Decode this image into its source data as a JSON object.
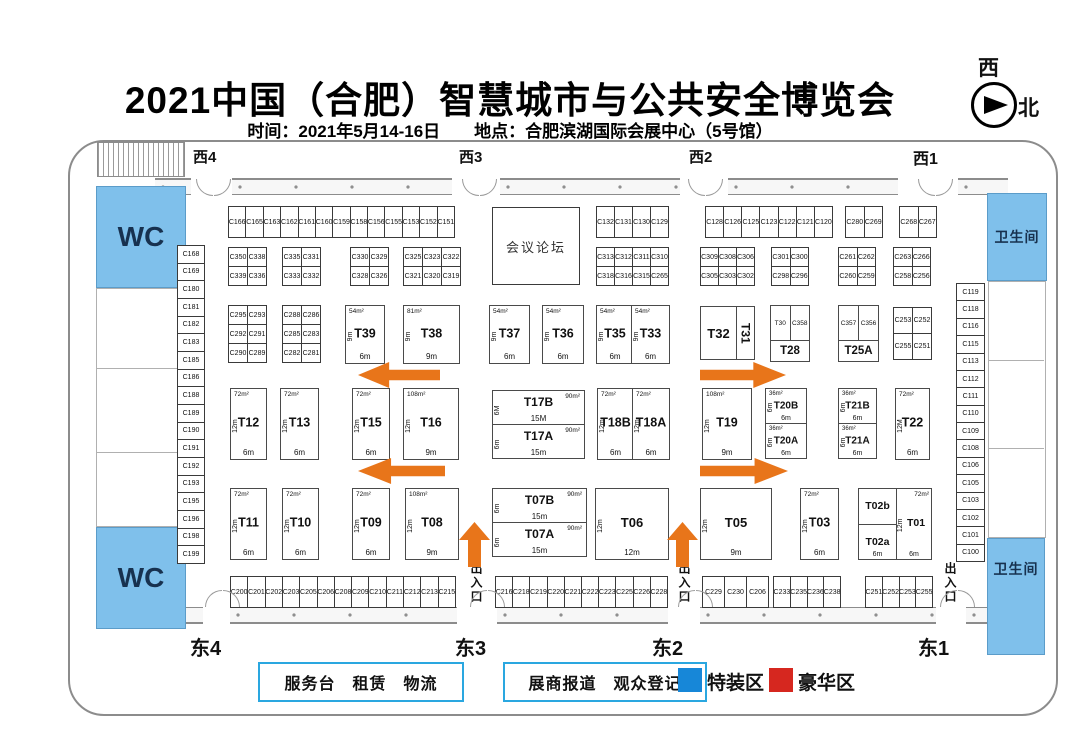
{
  "header": {
    "title": "2021中国（合肥）智慧城市与公共安全博览会",
    "subtitle": "时间：2021年5月14-16日　　地点：合肥滨湖国际会展中心（5号馆）",
    "compass_west": "西",
    "compass_north": "北"
  },
  "gates": {
    "west": [
      "西4",
      "西3",
      "西2",
      "西1"
    ],
    "east": [
      "东4",
      "东3",
      "东2",
      "东1"
    ],
    "entrance": "出入口"
  },
  "areas": {
    "wc": "WC",
    "restroom": "卫生间",
    "forum": "会议论坛"
  },
  "legend": {
    "service_box": "服务台　租赁　物流",
    "registration_box": "展商报道　观众登记",
    "special": "特装区",
    "deluxe": "豪华区"
  },
  "colors": {
    "arrow": "#e8751a",
    "facility_fill": "#7fc0eb",
    "legend_special": "#1787d8",
    "legend_deluxe": "#d6271f"
  },
  "cells": {
    "top_left": [
      "C166",
      "C165",
      "C163",
      "C162",
      "C161",
      "C160",
      "C159",
      "C158",
      "C156",
      "C155",
      "C153",
      "C152",
      "C151"
    ],
    "tr_a": [
      "C132",
      "C131",
      "C130",
      "C129"
    ],
    "tr_b": [
      "C128",
      "C126",
      "C125",
      "C123",
      "C122",
      "C121",
      "C120"
    ],
    "tr_c": [
      "C280",
      "C269"
    ],
    "tr_d": [
      "C268",
      "C267"
    ],
    "blk_c350": [
      "C350",
      "C338",
      "C339",
      "C336"
    ],
    "blk_c335": [
      "C335",
      "C331",
      "C333",
      "C332"
    ],
    "blk_c330": [
      "C330",
      "C329",
      "C328",
      "C326"
    ],
    "blk_c325": [
      "C325",
      "C323",
      "C322",
      "C321",
      "C320",
      "C319"
    ],
    "blk_c313": [
      "C313",
      "C312",
      "C311",
      "C310",
      "C318",
      "C316",
      "C315",
      "C265"
    ],
    "blk_c309": [
      "C309",
      "C308",
      "C306",
      "C305",
      "C303",
      "C302"
    ],
    "blk_c301": [
      "C301",
      "C300",
      "C298",
      "C296"
    ],
    "blk_c261": [
      "C261",
      "C262",
      "C260",
      "C259"
    ],
    "blk_c263": [
      "C263",
      "C266",
      "C258",
      "C256"
    ],
    "blk_c295": [
      "C295",
      "C293",
      "C292",
      "C291",
      "C290",
      "C289"
    ],
    "blk_c288": [
      "C288",
      "C286",
      "C285",
      "C283",
      "C282",
      "C281"
    ],
    "blk_c253": [
      "C253",
      "C252",
      "C255",
      "C251"
    ],
    "left_col": [
      "C168",
      "C169",
      "C180",
      "C181",
      "C182",
      "C183",
      "C185",
      "C186",
      "C188",
      "C189",
      "C190",
      "C191",
      "C192",
      "C193",
      "C195",
      "C196",
      "C198",
      "C199"
    ],
    "right_col": [
      "C119",
      "C118",
      "C116",
      "C115",
      "C113",
      "C112",
      "C111",
      "C110",
      "C109",
      "C108",
      "C106",
      "C105",
      "C103",
      "C102",
      "C101",
      "C100"
    ],
    "bottom_1": [
      "C200",
      "C201",
      "C202",
      "C203",
      "C205",
      "C206",
      "C208",
      "C209",
      "C210",
      "C211",
      "C212",
      "C213",
      "C215"
    ],
    "bottom_2": [
      "C216",
      "C218",
      "C219",
      "C220",
      "C221",
      "C222",
      "C223",
      "C225",
      "C226",
      "C228"
    ],
    "bottom_3": [
      "C229",
      "C230",
      "C206"
    ],
    "bottom_4": [
      "C233",
      "C235",
      "C236",
      "C238"
    ],
    "bottom_5": [
      "C251",
      "C252",
      "C253",
      "C255"
    ]
  },
  "t_booths": {
    "T39": {
      "id": "T39",
      "area": "54m²",
      "side": "9m",
      "front": "6m"
    },
    "T38": {
      "id": "T38",
      "area": "81m²",
      "side": "9m",
      "front": "9m"
    },
    "T37": {
      "id": "T37",
      "area": "54m²",
      "side": "9m",
      "front": "6m"
    },
    "T36": {
      "id": "T36",
      "area": "54m²",
      "side": "9m",
      "front": "6m"
    },
    "T35": {
      "id": "T35",
      "area": "54m²",
      "side": "9m",
      "front": "6m"
    },
    "T33": {
      "id": "T33",
      "area": "54m²",
      "side": "9m",
      "front": "6m"
    },
    "T12": {
      "id": "T12",
      "area": "72m²",
      "side": "12m",
      "front": "6m"
    },
    "T13": {
      "id": "T13",
      "area": "72m²",
      "side": "12m",
      "front": "6m"
    },
    "T15": {
      "id": "T15",
      "area": "72m²",
      "side": "12m",
      "front": "6m"
    },
    "T16": {
      "id": "T16",
      "area": "108m²",
      "side": "12m",
      "front": "9m"
    },
    "T17B": {
      "id": "T17B",
      "area": "90m²",
      "side": "6M",
      "front": "15M"
    },
    "T17A": {
      "id": "T17A",
      "area": "90m²",
      "side": "6m",
      "front": "15m"
    },
    "T18B": {
      "id": "T18B",
      "area": "72m²",
      "side": "12m",
      "front": "6m"
    },
    "T18A": {
      "id": "T18A",
      "area": "72m²",
      "side": "12m",
      "front": "6m"
    },
    "T19": {
      "id": "T19",
      "area": "108m²",
      "side": "12m",
      "front": "9m"
    },
    "T20B": {
      "id": "T20B",
      "area": "36m²",
      "side": "6m",
      "front": "6m"
    },
    "T20A": {
      "id": "T20A",
      "area": "36m²",
      "side": "6m",
      "front": "6m"
    },
    "T21B": {
      "id": "T21B",
      "area": "36m²",
      "side": "6m",
      "front": "6m"
    },
    "T21A": {
      "id": "T21A",
      "area": "36m²",
      "side": "6m",
      "front": "6m"
    },
    "T22": {
      "id": "T22",
      "area": "72m²",
      "side": "12M",
      "front": "6m"
    },
    "T11": {
      "id": "T11",
      "area": "72m²",
      "side": "12m",
      "front": "6m"
    },
    "T10": {
      "id": "T10",
      "area": "72m²",
      "side": "12m",
      "front": "6m"
    },
    "T09": {
      "id": "T09",
      "area": "72m²",
      "side": "12m",
      "front": "6m"
    },
    "T08": {
      "id": "T08",
      "area": "108m²",
      "side": "12m",
      "front": "9m"
    },
    "T07B": {
      "id": "T07B",
      "area": "90m²",
      "side": "6m",
      "front": "15m"
    },
    "T07A": {
      "id": "T07A",
      "area": "90m²",
      "side": "6m",
      "front": "15m"
    },
    "T06": {
      "id": "T06",
      "side": "12m",
      "front": "12m"
    },
    "T05": {
      "id": "T05",
      "side": "12m",
      "front": "9m"
    },
    "T03": {
      "id": "T03",
      "area": "72m²",
      "side": "12m",
      "front": "6m"
    }
  },
  "t32_block": {
    "main": "T32",
    "rotated": "T31"
  },
  "t28_block": {
    "cell_a": "T30",
    "cell_b": "C358",
    "main": "T28"
  },
  "t25a_block": {
    "cell_a": "C357",
    "cell_b": "C356",
    "main": "T25A"
  },
  "t02_block": {
    "area": "72m²",
    "top_left": "T02b",
    "bottom_left": "T02a",
    "right": "T01",
    "side": "12m",
    "front_left": "6m",
    "front_right": "6m"
  }
}
